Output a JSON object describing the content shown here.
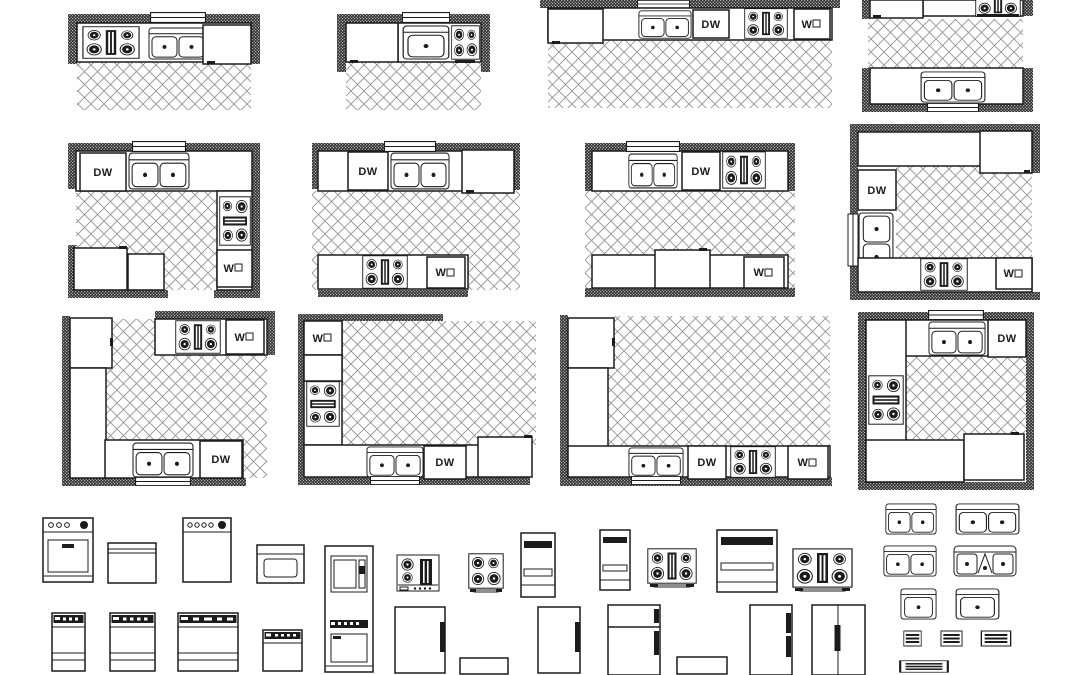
{
  "drawing": {
    "background": "#ffffff",
    "ink": "#1c1c1c",
    "floor_hatch": "#949494"
  },
  "labels": {
    "dishwasher": "DW",
    "wall_oven": "W"
  },
  "kitchens": [
    {
      "id": "kitchen-1",
      "layout": "single-wall",
      "appliances": [
        "range",
        "double-sink",
        "cabinet"
      ]
    },
    {
      "id": "kitchen-2",
      "layout": "single-wall",
      "appliances": [
        "refrigerator",
        "single-sink",
        "range"
      ]
    },
    {
      "id": "kitchen-3",
      "layout": "single-wall",
      "appliances": [
        "refrigerator",
        "double-sink",
        "dishwasher",
        "range",
        "wall-oven"
      ]
    },
    {
      "id": "kitchen-4",
      "layout": "galley",
      "appliances": [
        "refrigerator",
        "range",
        "double-sink"
      ]
    },
    {
      "id": "kitchen-5",
      "layout": "u-shape",
      "appliances": [
        "dishwasher",
        "double-sink",
        "range",
        "wall-oven",
        "refrigerator",
        "cabinet"
      ]
    },
    {
      "id": "kitchen-6",
      "layout": "galley",
      "appliances": [
        "dishwasher",
        "double-sink",
        "refrigerator",
        "range",
        "wall-oven"
      ]
    },
    {
      "id": "kitchen-7",
      "layout": "galley",
      "appliances": [
        "double-sink",
        "dishwasher",
        "range",
        "refrigerator",
        "wall-oven"
      ]
    },
    {
      "id": "kitchen-8",
      "layout": "u-shape",
      "appliances": [
        "refrigerator",
        "dishwasher",
        "double-sink",
        "range",
        "wall-oven"
      ]
    },
    {
      "id": "kitchen-9",
      "layout": "l-shape",
      "appliances": [
        "refrigerator",
        "range",
        "wall-oven",
        "double-sink",
        "dishwasher"
      ]
    },
    {
      "id": "kitchen-10",
      "layout": "l-shape",
      "appliances": [
        "wall-oven",
        "cabinet",
        "range",
        "double-sink",
        "dishwasher",
        "refrigerator"
      ]
    },
    {
      "id": "kitchen-11",
      "layout": "l-shape",
      "appliances": [
        "refrigerator",
        "double-sink",
        "dishwasher",
        "range",
        "wall-oven"
      ]
    },
    {
      "id": "kitchen-12",
      "layout": "u-shape",
      "appliances": [
        "double-sink",
        "dishwasher",
        "range",
        "refrigerator"
      ]
    }
  ],
  "library": {
    "row_elevations": [
      "range-with-oven-window",
      "dishwasher-front",
      "range-front",
      "wall-oven-front",
      "oven-microwave-tower",
      "cooktop-plan",
      "range-plan-4-burner",
      "wall-oven-narrow",
      "wall-oven-narrow",
      "range-plan-grill",
      "wall-oven-wide",
      "range-plan-grill-wide"
    ],
    "row_fronts": [
      "range-front-narrow",
      "range-front-medium",
      "range-front-wide",
      "range-front-compact",
      "refrigerator-front",
      "base-cabinet-front",
      "refrigerator-front",
      "refrigerator-top-freezer-front",
      "base-cabinet-front",
      "refrigerator-two-handle-front",
      "refrigerator-side-by-side-front"
    ],
    "sinks_and_vents": [
      "double-sink-plan",
      "double-sink-wide-plan",
      "double-sink-plan",
      "corner-sink-plan",
      "single-sink-plan",
      "single-sink-wide-plan",
      "vent-grille-small",
      "vent-grille-medium",
      "vent-grille-large",
      "vent-grille-wide"
    ]
  }
}
